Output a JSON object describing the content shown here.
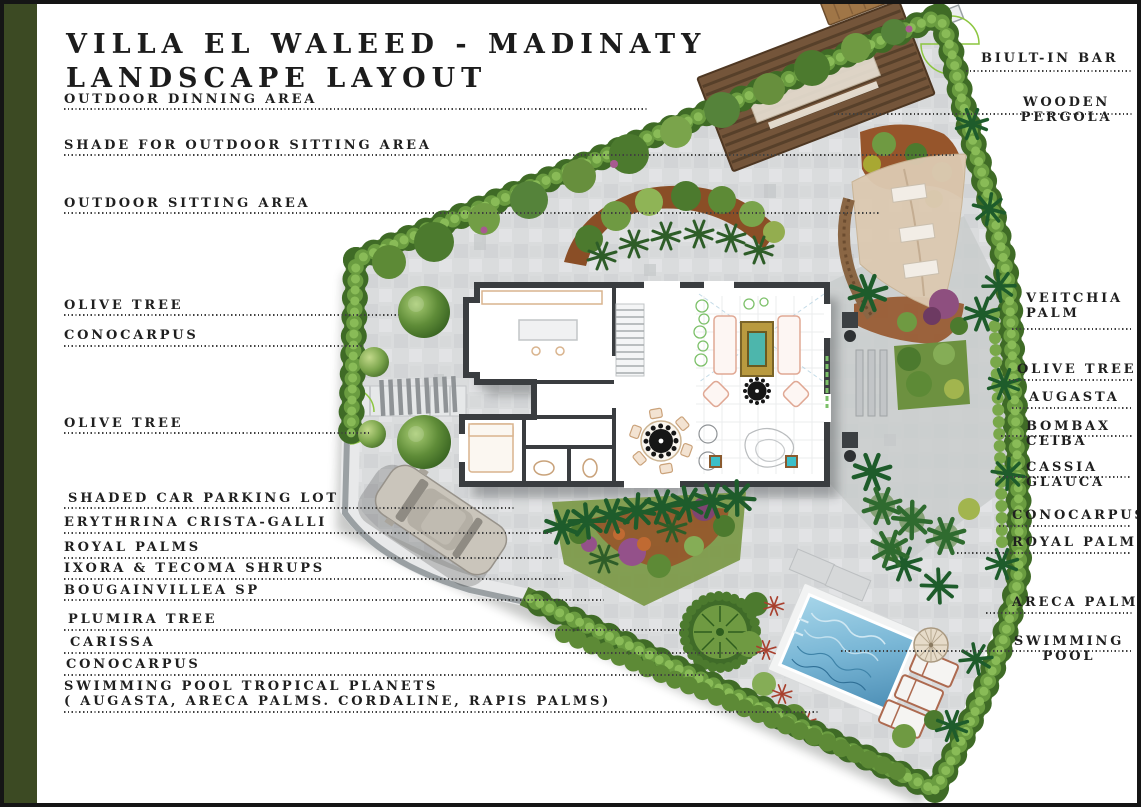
{
  "page": {
    "title_line1": "VILLA EL WALEED - MADINATY",
    "title_line2": "LANDSCAPE LAYOUT"
  },
  "labels_left": [
    {
      "text": "OUTDOOR DINNING AREA"
    },
    {
      "text": "SHADE FOR OUTDOOR SITTING AREA"
    },
    {
      "text": "OUTDOOR SITTING AREA"
    },
    {
      "text": "OLIVE TREE"
    },
    {
      "text": "CONOCARPUS"
    },
    {
      "text": "OLIVE TREE"
    },
    {
      "text": "SHADED CAR PARKING LOT"
    },
    {
      "text": "ERYTHRINA CRISTA-GALLI"
    },
    {
      "text": "ROYAL PALMS"
    },
    {
      "text": "IXORA & TECOMA SHRUPS"
    },
    {
      "text": "BOUGAINVILLEA SP"
    },
    {
      "text": "PLUMIRA TREE"
    },
    {
      "text": "CARISSA"
    },
    {
      "text": "CONOCARPUS"
    },
    {
      "text": "SWIMMING POOL TROPICAL PLANETS",
      "text2": "( AUGASTA, ARECA PALMS. CORDALINE, RAPIS PALMS)"
    }
  ],
  "labels_right": [
    {
      "text": "BIULT-IN BAR"
    },
    {
      "text": "WOODEN",
      "text2": "PERGOLA"
    },
    {
      "text": "VEITCHIA",
      "text2": "PALM"
    },
    {
      "text": "OLIVE TREE"
    },
    {
      "text": "AUGASTA"
    },
    {
      "text": "BOMBAX",
      "text2": "CEIBA"
    },
    {
      "text": "CASSIA",
      "text2": "GLAUCA"
    },
    {
      "text": "CONOCARPUS"
    },
    {
      "text": "ROYAL PALMS"
    },
    {
      "text": "ARECA PALMS"
    },
    {
      "text": "SWIMMING",
      "text2": "POOL"
    }
  ],
  "palette": {
    "accent_bar_olive": "#3c4a23",
    "hedge_green": "#4c7a2e",
    "pool_blue": "#79b7d5",
    "pergola_wood": "#6e4f33",
    "shade_sail_tan": "#dcc9b1",
    "paving_gray": "#dadcdd",
    "mulch_brown": "#94522a",
    "label_ink": "#1f1f1f"
  }
}
